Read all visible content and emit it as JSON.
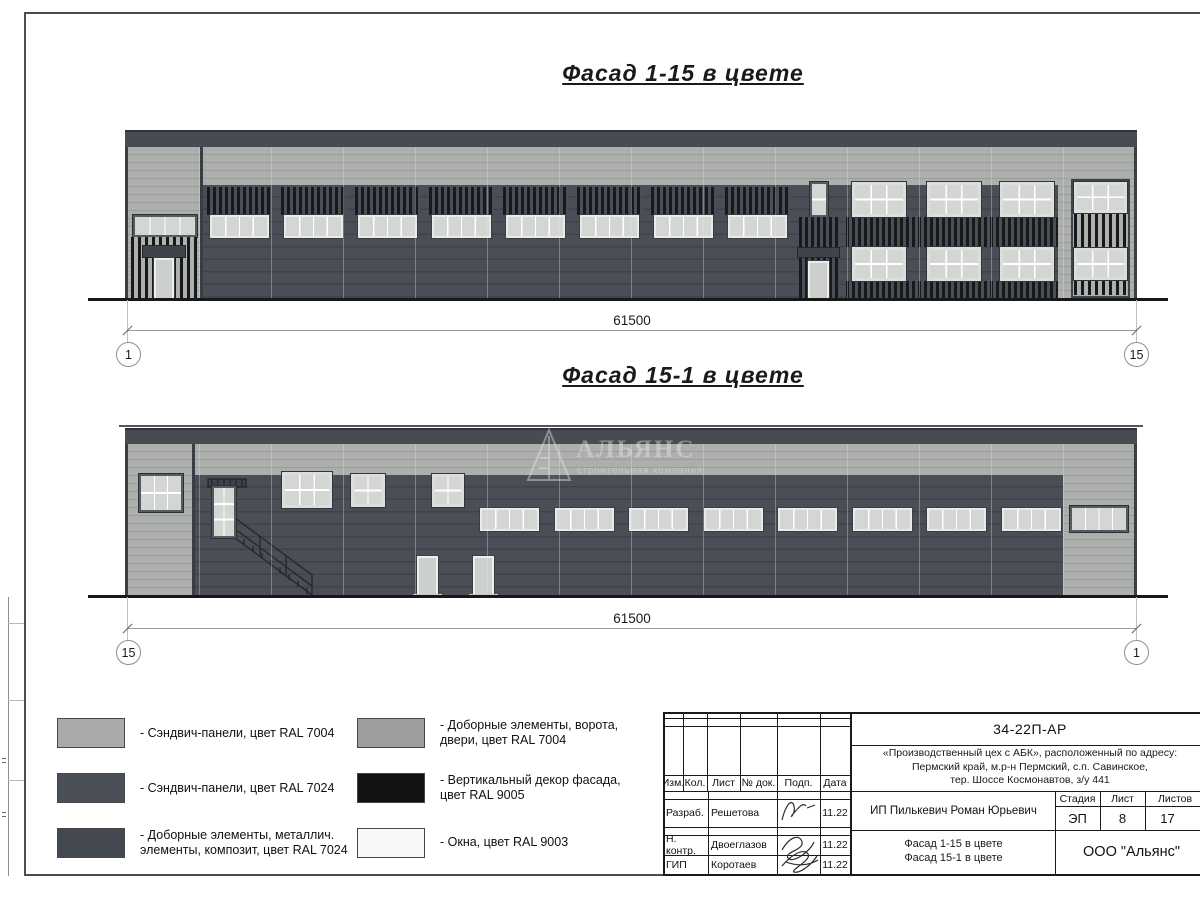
{
  "facade1": {
    "title": "Фасад 1-15 в цвете",
    "dimension": "61500",
    "axis_left": "1",
    "axis_right": "15"
  },
  "facade2": {
    "title": "Фасад 15-1 в цвете",
    "dimension": "61500",
    "axis_left": "15",
    "axis_right": "1"
  },
  "watermark": {
    "name": "АЛЬЯНС",
    "tagline": "строительная компания"
  },
  "colors": {
    "ral7004_panels": "#a9aba8",
    "ral7024_panels": "#4b5058",
    "ral7024_elements": "#434851",
    "ral7004_doors": "#9c9e9b",
    "ral9005_decor": "#121212",
    "ral9003_windows": "#f7f7f5"
  },
  "legend": {
    "col1": [
      {
        "line1": "- Сэндвич-панели, цвет RAL 7004",
        "line2": ""
      },
      {
        "line1": "- Сэндвич-панели, цвет RAL 7024",
        "line2": ""
      },
      {
        "line1": "- Доборные элементы, металлич.",
        "line2": "элементы, композит, цвет RAL 7024"
      }
    ],
    "col2": [
      {
        "line1": "- Доборные элементы, ворота,",
        "line2": "двери, цвет RAL 7004"
      },
      {
        "line1": "- Вертикальный декор фасада,",
        "line2": "цвет RAL 9005"
      },
      {
        "line1": "- Окна, цвет RAL 9003",
        "line2": ""
      }
    ]
  },
  "titleblock": {
    "doc_number": "34-22П-АР",
    "project_line1": "«Производственный цех с АБК», расположенный по адресу:",
    "project_line2": "Пермский край, м.р-н Пермский, с.п. Савинское,",
    "project_line3": "тер. Шоссе Космонавтов, з/у 441",
    "header": {
      "izm": "Изм.",
      "kol": "Кол.",
      "list": "Лист",
      "doc": "№ док.",
      "podp": "Подп.",
      "data": "Дата"
    },
    "rows": [
      {
        "role": "Разраб.",
        "name": "Решетова",
        "date": "11.22"
      },
      {
        "role": "Н. контр.",
        "name": "Двоеглазов",
        "date": "11.22"
      },
      {
        "role": "ГИП",
        "name": "Коротаев",
        "date": "11.22"
      }
    ],
    "client": "ИП Пилькевич Роман Юрьевич",
    "stage_label": "Стадия",
    "sheet_label": "Лист",
    "sheets_label": "Листов",
    "stage": "ЭП",
    "sheet": "8",
    "sheets": "17",
    "sheet_title_line1": "Фасад 1-15 в цвете",
    "sheet_title_line2": "Фасад 15-1 в цвете",
    "company": "ООО \"Альянс\""
  }
}
